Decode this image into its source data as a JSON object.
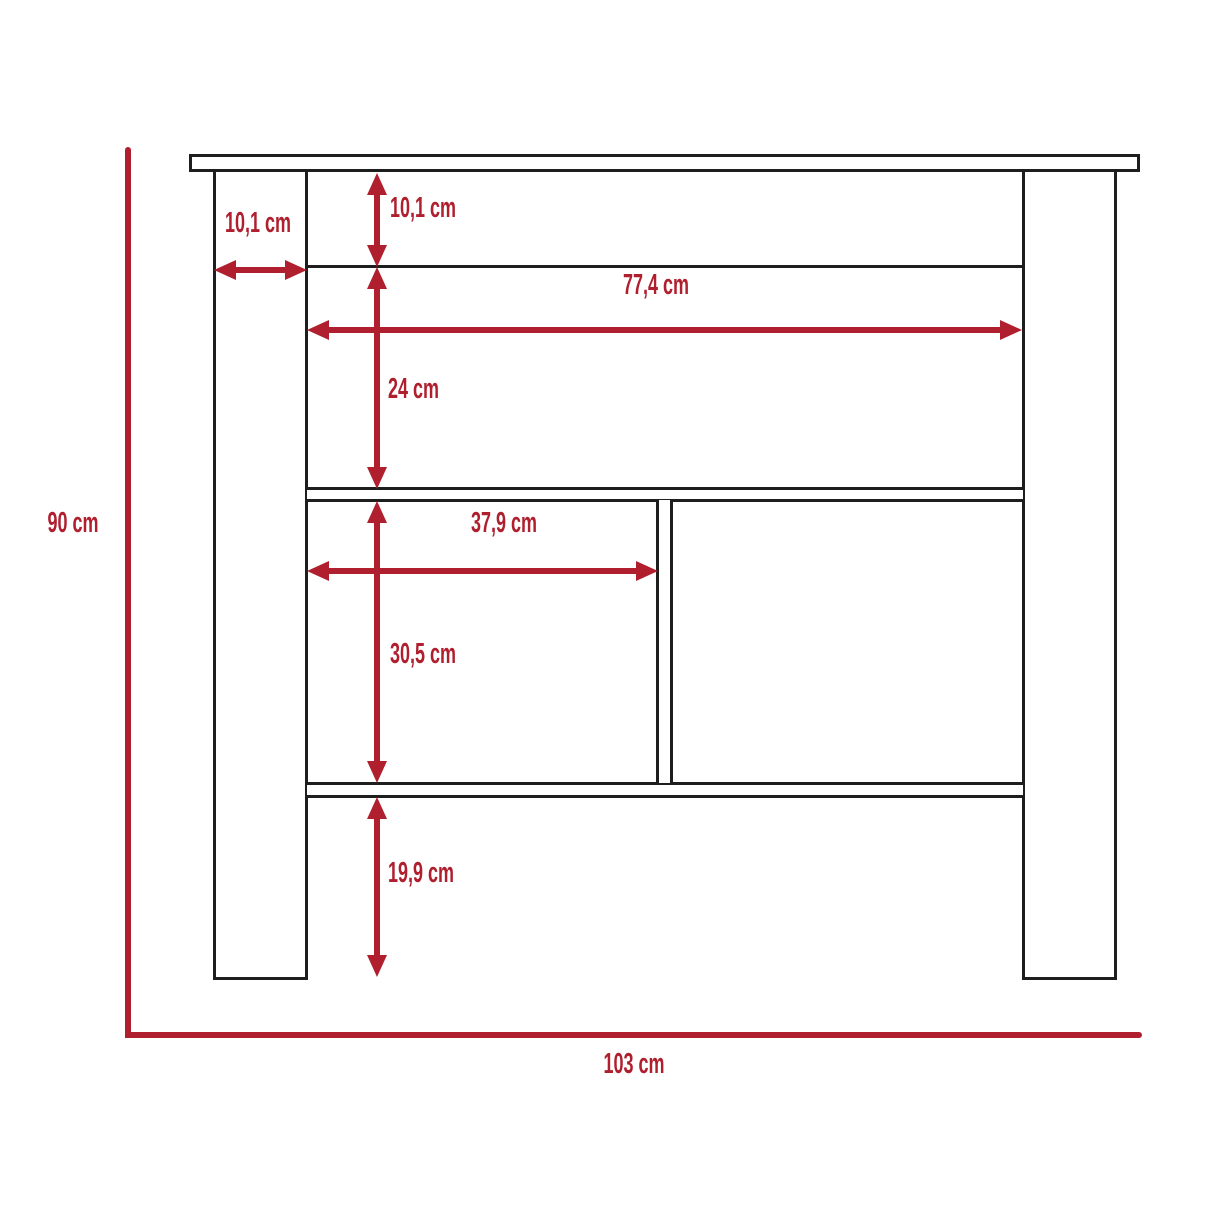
{
  "diagram": {
    "kind": "furniture dimensional drawing",
    "subject": "kitchen island / cabinet front elevation",
    "unit": "cm"
  },
  "colors": {
    "dimension_red": "#AF1F2E",
    "outline_black": "#1E1E1E",
    "background": "#FFFFFF"
  },
  "labels": {
    "overall_height": "90 cm",
    "overall_width": "103 cm",
    "leg_width": "10,1 cm",
    "top_rail_height": "10,1 cm",
    "upper_shelf_height": "24 cm",
    "inner_width": "77,4 cm",
    "left_cubby_width": "37,9 cm",
    "cubby_height": "30,5 cm",
    "bottom_clearance": "19,9 cm"
  },
  "measurements_cm": {
    "overall_height": 90,
    "overall_width": 103,
    "leg_width": 10.1,
    "top_rail_height": 10.1,
    "upper_shelf_height": 24,
    "inner_width": 77.4,
    "left_cubby_width": 37.9,
    "cubby_height": 30.5,
    "bottom_clearance": 19.9
  }
}
